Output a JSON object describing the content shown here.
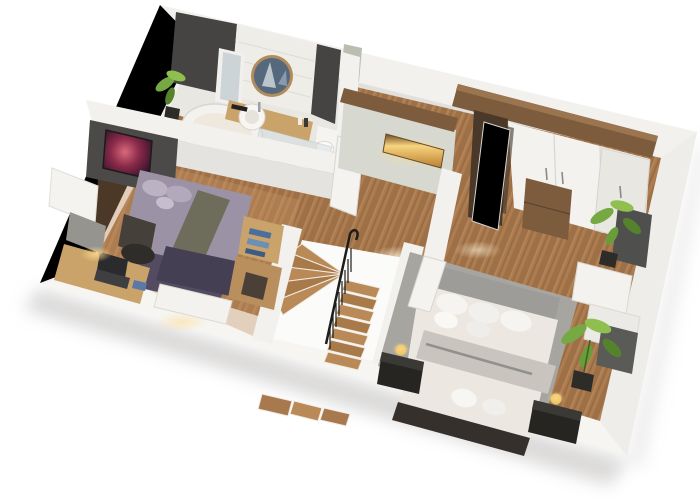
{
  "scene": {
    "type": "3d-floor-plan-render",
    "description": "Isometric cut-away 3D render of an upper floor: bathroom top-left, bedroom with purple bed on the left, central winding staircase with black railing, hallway sideboard with lit niche, and a large bedroom with white bedding, wardrobe and plants on the right.",
    "view": "rotated top-down isometric, white background"
  },
  "palette": {
    "background": "#ffffff",
    "wall_top": "#f2f1ee",
    "wall_top_bright": "#f6f5f2",
    "wall_face": "#e4e3df",
    "wall_dark": "#454443",
    "tile": "#efede8",
    "floor_wood": "#a9794e",
    "floor_wood_light": "#c49365",
    "bath_floor": "#e9e7e2",
    "rug_left": "#534b61",
    "bed_left_duvet": "#9c92a6",
    "bed_left_runner": "#6e6c5a",
    "bed_left_throw": "#453f54",
    "bed_right_bedding": "#ece8e1",
    "headboard_gray": "#9d9c98",
    "throw_gray": "#c9c5be",
    "rug_right": "#a6a5a0",
    "bed_frame_dark": "#35302b",
    "wood_furniture": "#c9a369",
    "walnut": "#7d5c3e",
    "walnut_dark": "#4a3828",
    "white_furniture": "#f3f2ef",
    "plant_green": "#76a844",
    "plant_green_dark": "#55822c",
    "pot_dark": "#2e2c29",
    "lamp_gold": "#e4c05e",
    "niche_glow": "#f2c26a",
    "mirror_glass": "#56687c",
    "rail_black": "#1d1d1b",
    "glass": "#cdd8dd",
    "shadow": "#bdbcb9"
  },
  "rooms": [
    {
      "id": "bathroom",
      "label": "Bathroom",
      "objects": [
        "bathtub",
        "vanity-counter",
        "vessel-sink",
        "round-mirror",
        "mirror-cabinet",
        "toilet",
        "shower-glass",
        "towels",
        "plant"
      ]
    },
    {
      "id": "bedroom-left",
      "label": "Left bedroom",
      "objects": [
        "double-bed-purple",
        "galaxy-tv",
        "desk",
        "laptop",
        "office-chair",
        "purple-rug",
        "window-blind",
        "shelf-with-clothes",
        "white-bench"
      ]
    },
    {
      "id": "hallway",
      "label": "Hallway",
      "objects": [
        "sideboard-with-lit-niche",
        "open-door"
      ]
    },
    {
      "id": "staircase",
      "label": "Winding staircase",
      "objects": [
        "wood-treads",
        "black-railing",
        "stairwell-walls"
      ]
    },
    {
      "id": "bedroom-right",
      "label": "Right bedroom",
      "objects": [
        "double-bed-white",
        "gray-headboard",
        "gray-rug",
        "nightstands",
        "gold-lamps",
        "wardrobe",
        "open-wardrobe-doors",
        "wood-drawers",
        "plants",
        "wall-panel",
        "white-console"
      ]
    }
  ]
}
